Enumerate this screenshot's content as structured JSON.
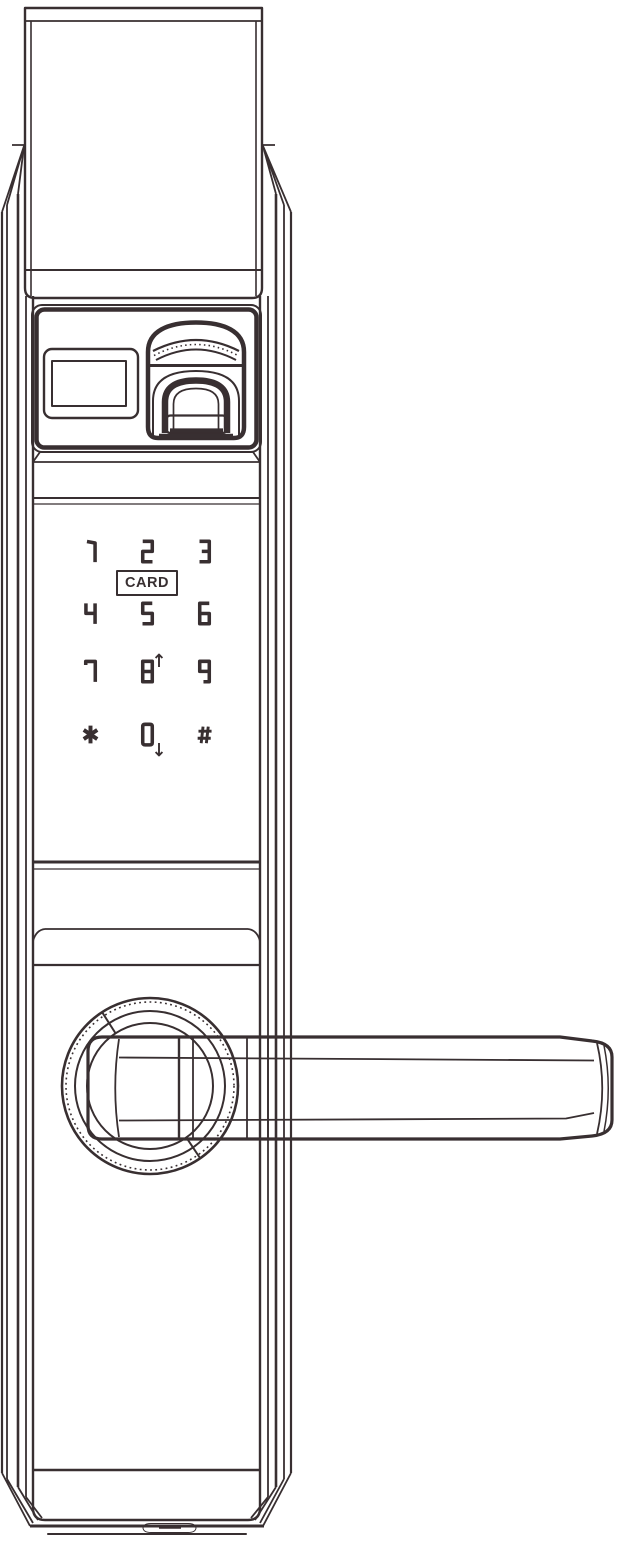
{
  "meta": {
    "type": "technical line drawing",
    "subject": "smart door lock front view with fingerprint scanner, touch keypad and lever handle"
  },
  "colors": {
    "line": "#382f31",
    "background": "#ffffff"
  },
  "top_module": {
    "indicator_window_icon": "indicator-window",
    "fingerprint_icon": "fingerprint-scanner"
  },
  "keypad": {
    "card_label": "CARD",
    "layout": {
      "col_centers_x": [
        90,
        147,
        204
      ],
      "row_centers_y": [
        551,
        613,
        671,
        734
      ]
    },
    "keys": [
      {
        "id": "1",
        "glyph": "1"
      },
      {
        "id": "2",
        "glyph": "2"
      },
      {
        "id": "3",
        "glyph": "3"
      },
      {
        "id": "4",
        "glyph": "4"
      },
      {
        "id": "5",
        "glyph": "5"
      },
      {
        "id": "6",
        "glyph": "6"
      },
      {
        "id": "7",
        "glyph": "7"
      },
      {
        "id": "8",
        "glyph": "8",
        "arrow": "up"
      },
      {
        "id": "9",
        "glyph": "9"
      },
      {
        "id": "star",
        "glyph": "*"
      },
      {
        "id": "0",
        "glyph": "0",
        "arrow": "down"
      },
      {
        "id": "hash",
        "glyph": "#"
      }
    ]
  },
  "hardware": {
    "handle_icon": "lever-handle",
    "rosette_icon": "handle-rosette",
    "bottom_port_icon": "bottom-port-slot"
  }
}
